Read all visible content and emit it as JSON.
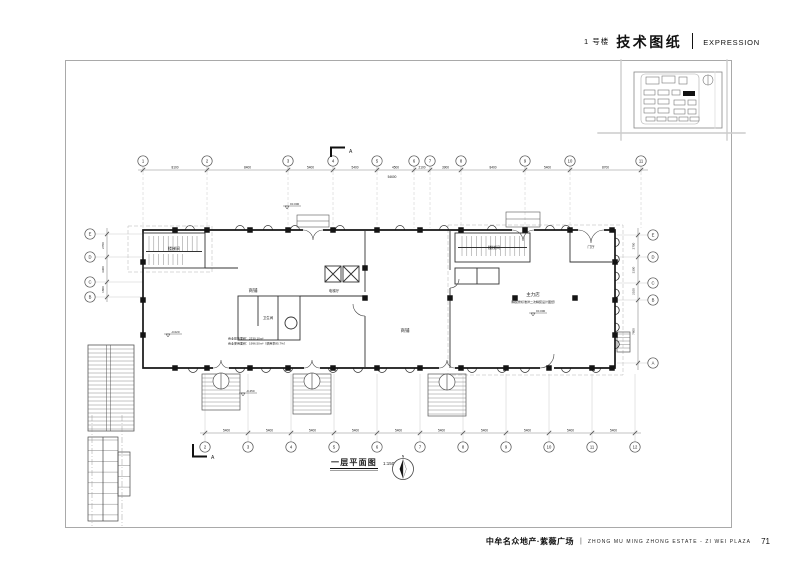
{
  "header": {
    "building": "1 号楼",
    "title": "技术图纸",
    "subtitle": "EXPRESSION"
  },
  "plan": {
    "caption": "一层平面图",
    "scale": "1:150",
    "north": "N",
    "section": "A",
    "grid_top": [
      "1",
      "2",
      "3",
      "4",
      "5",
      "6",
      "7",
      "8",
      "9",
      "10",
      "11"
    ],
    "grid_bottom": [
      "2",
      "3",
      "4",
      "5",
      "6",
      "7",
      "8",
      "9",
      "10",
      "11",
      "12"
    ],
    "grid_left": [
      "E",
      "D",
      "C",
      "B"
    ],
    "grid_right": [
      "E",
      "D",
      "C",
      "B",
      "A"
    ],
    "dims_top": [
      "8100",
      "8400",
      "5400",
      "5400",
      "4500",
      "2100",
      "3900",
      "8400",
      "5400",
      "8700"
    ],
    "dims_top_total": "54600",
    "dims_bottom": [
      "5400",
      "5400",
      "5400",
      "5400",
      "5400",
      "5400",
      "5400",
      "5400",
      "5400",
      "5400"
    ],
    "dims_left": [
      "2700",
      "3300",
      "1800"
    ],
    "dims_right": [
      "2700",
      "3300",
      "2100",
      "7800"
    ],
    "rooms": [
      "楼梯间",
      "商铺",
      "电梯厅",
      "卫生间",
      "楼梯间",
      "门厅",
      "主力店",
      "商铺"
    ],
    "notes": [
      "商业建筑面积：2330.10m²",
      "商业使用面积：1996.50m²（使用率85.7%）",
      "（精装修标准详二次精装设计图纸）"
    ],
    "marks": [
      "±0.000",
      "±0.000",
      "-0.450",
      "-0.020"
    ]
  },
  "footer": {
    "project_cn": "中牟名众地产·紫薇广场",
    "project_en": "ZHONG MU MING ZHONG ESTATE - ZI WEI PLAZA",
    "page": "71"
  }
}
